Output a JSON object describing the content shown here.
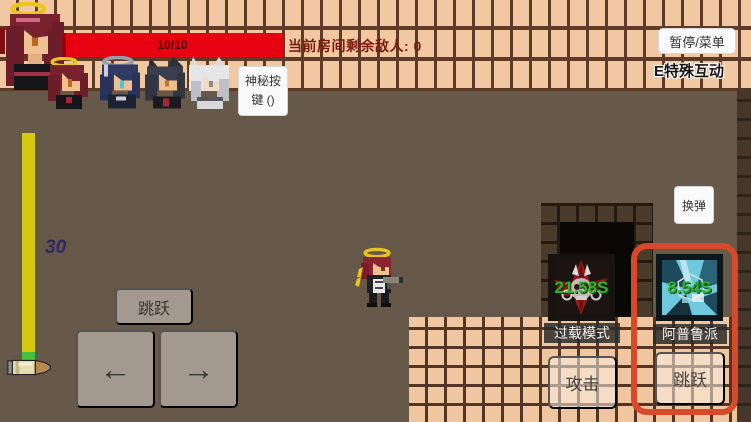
{
  "hud": {
    "health_value": "10/10",
    "enemy_counter": "当前房间剩余敌人: 0",
    "pause_menu": "暂停/菜单",
    "special_interact": "E特殊互动",
    "mystery_line1": "神秘按",
    "mystery_line2": "键 ()",
    "ammo_count": "30",
    "reload": "换弹"
  },
  "controls": {
    "jump": "跳跃",
    "move_left": "←",
    "move_right": "→",
    "attack": "攻击",
    "skill_jump": "跳跃"
  },
  "skills": [
    {
      "name": "过载模式",
      "cooldown": "21.58S"
    },
    {
      "name": "阿普鲁派",
      "cooldown": "8.54S"
    }
  ],
  "team": {
    "leader_icon": "red-haired-halo-portrait",
    "member_icons": [
      "red-haired-halo-portrait",
      "blue-haired-halo-portrait",
      "black-haired-wolf-ears-portrait",
      "white-haired-wolf-ears-portrait"
    ]
  },
  "colors": {
    "health_red": "#e60210",
    "ammo_bar_yellow": "#d6c90f",
    "ammo_tip_green": "#42c23c",
    "cooldown_green": "#2fb42f",
    "highlight_border": "#d7492b",
    "tile_tan": "#f1c8a1",
    "wall_brown": "#675949"
  }
}
